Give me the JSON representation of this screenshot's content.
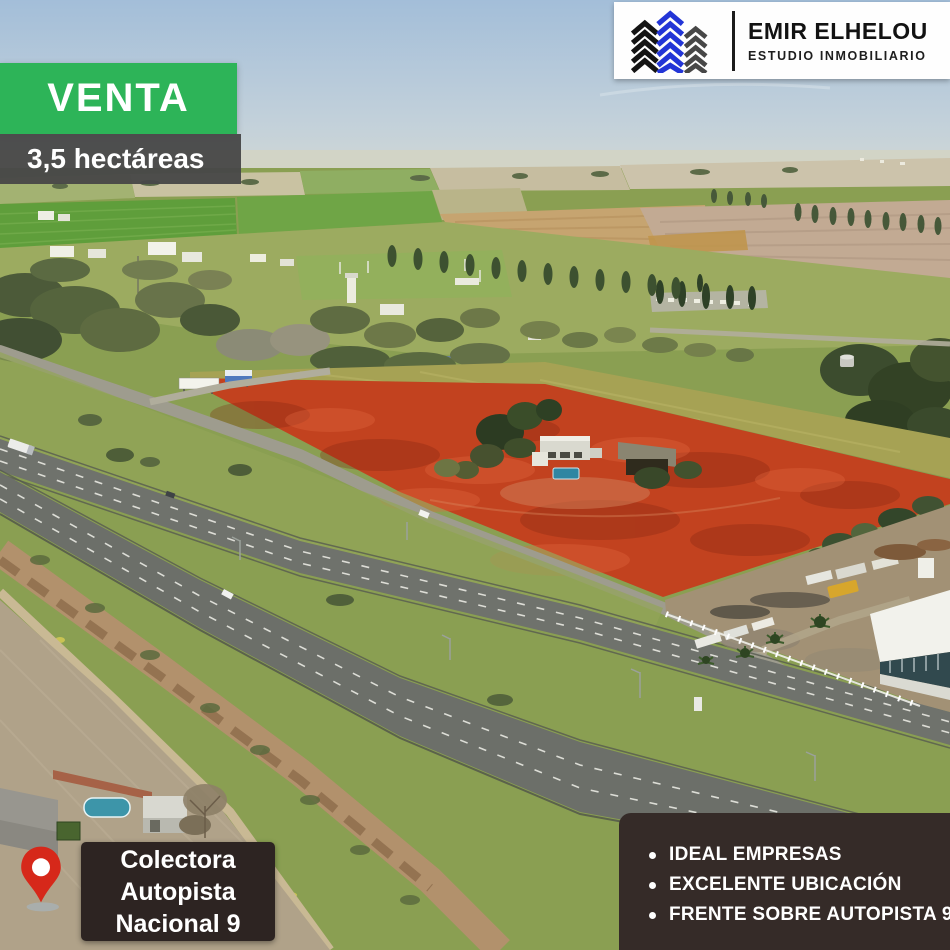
{
  "listing": {
    "status_banner": "VENTA",
    "size_banner": "3,5 hectáreas",
    "location_card": {
      "line1": "Colectora",
      "line2": "Autopista",
      "line3": "Nacional 9"
    },
    "features_card": {
      "items": [
        "IDEAL EMPRESAS",
        "EXCELENTE UBICACIÓN",
        "FRENTE SOBRE AUTOPISTA 9"
      ]
    },
    "brand": {
      "name": "EMIR ELHELOU",
      "subtitle": "ESTUDIO INMOBILIARIO"
    }
  },
  "icons": {
    "map_pin": "red map pin marking the plot frontage",
    "buildings_logo": "striped chevron buildings logo in black, blue and gray"
  },
  "colors": {
    "accent_green": "#2db458",
    "size_banner_bg": "#484848",
    "location_card_bg": "#2d2422",
    "features_card_bg": "#352b28",
    "plot_highlight_red": "#c2421f",
    "pin_red": "#d6281a",
    "logo_blue": "#2335d6"
  }
}
